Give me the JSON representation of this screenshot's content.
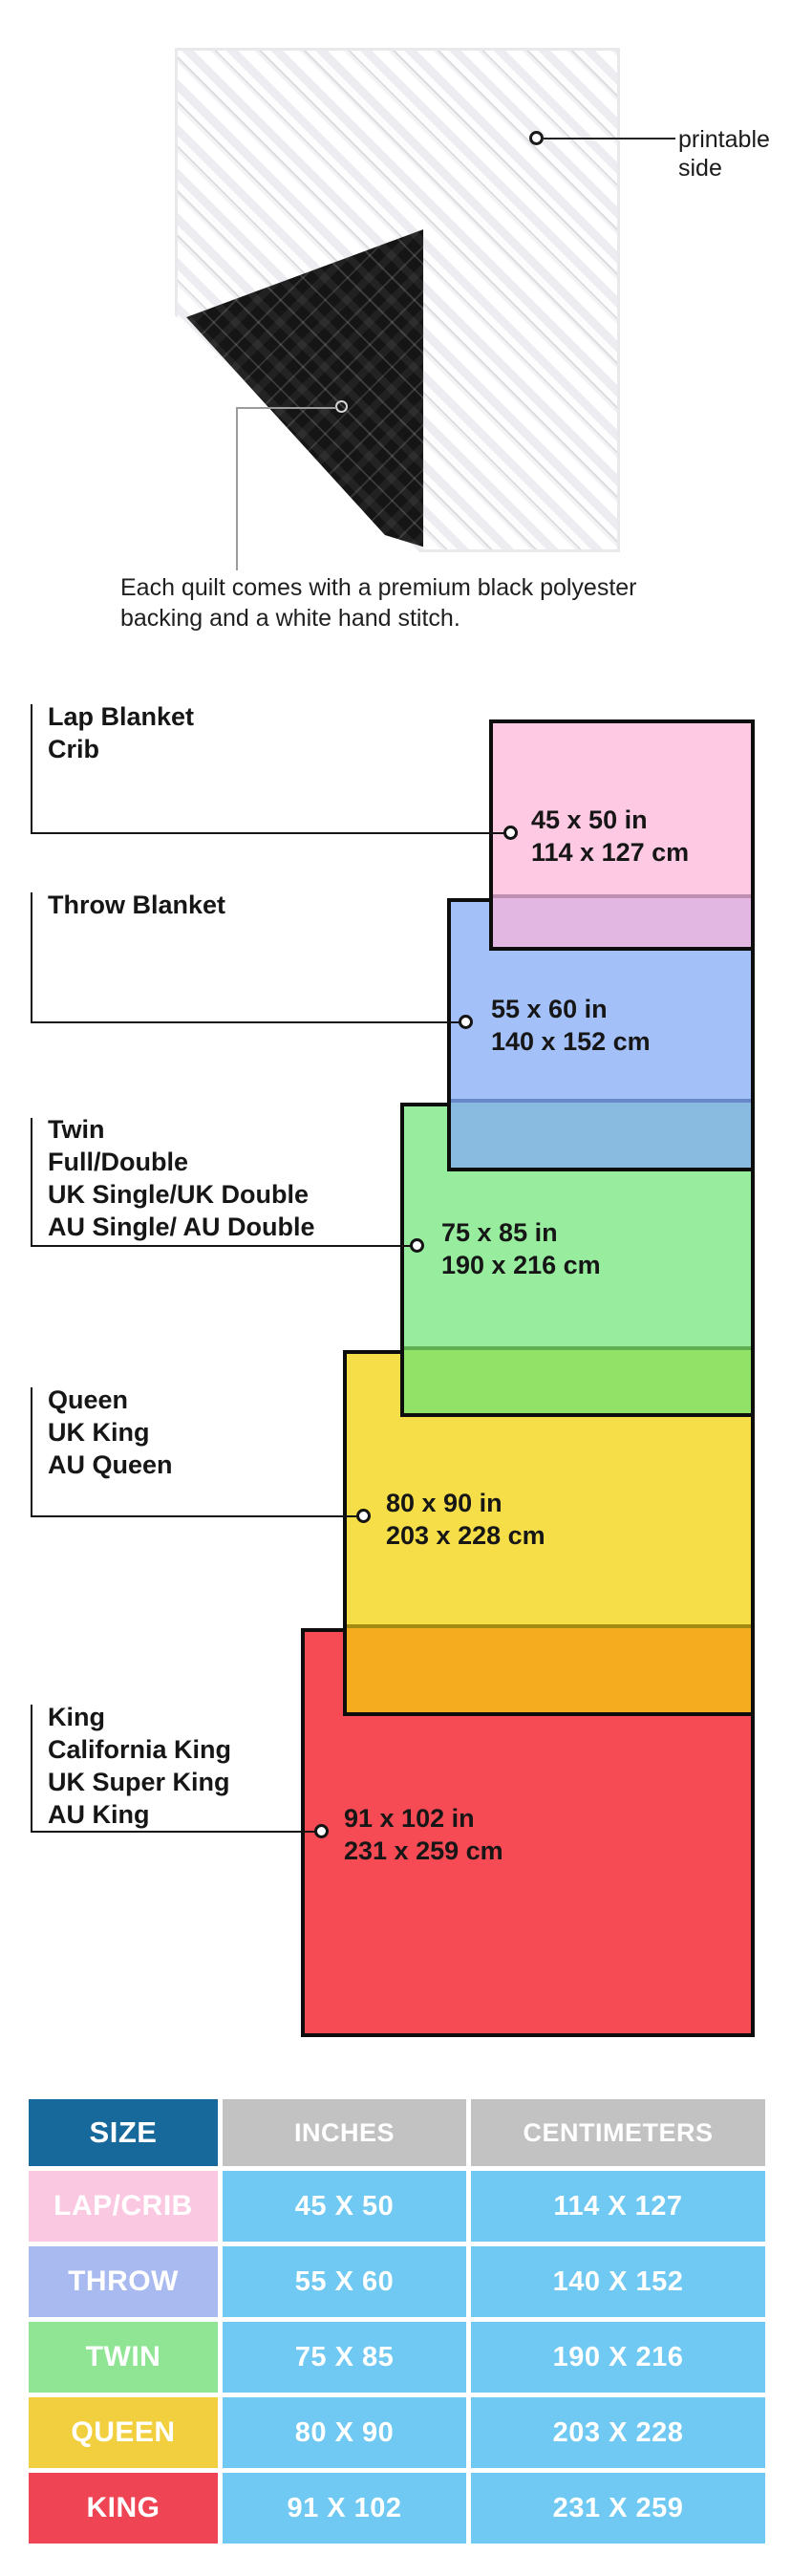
{
  "quilt_figure": {
    "printable_label": "printable side",
    "caption_lines": [
      "Each quilt comes with a premium black polyester",
      "backing and a white hand stitch."
    ],
    "front_color": "#fafafa",
    "backing_color": "#151515"
  },
  "size_diagram": {
    "items": [
      {
        "id": "lap-crib",
        "label_lines": [
          "Lap Blanket",
          "Crib"
        ],
        "inches": "45 x 50 in",
        "centimeters": "114 x 127 cm",
        "fill": "#FEC9E2",
        "overlap_fill": "#E2B7E2"
      },
      {
        "id": "throw",
        "label_lines": [
          "Throw Blanket"
        ],
        "inches": "55 x 60 in",
        "centimeters": "140 x 152 cm",
        "fill": "#A4C0F8",
        "overlap_fill": "#89BBE1"
      },
      {
        "id": "twin",
        "label_lines": [
          "Twin",
          "Full/Double",
          "UK Single/UK Double",
          "AU Single/ AU Double"
        ],
        "inches": "75 x 85 in",
        "centimeters": "190 x 216 cm",
        "fill": "#97EC9E",
        "overlap_fill": "#92E268"
      },
      {
        "id": "queen",
        "label_lines": [
          "Queen",
          "UK King",
          "AU Queen"
        ],
        "inches": "80 x 90 in",
        "centimeters": "203 x 228 cm",
        "fill": "#F5DE48",
        "overlap_fill": "#F5AC1E"
      },
      {
        "id": "king",
        "label_lines": [
          "King",
          "California King",
          "UK Super King",
          "AU King"
        ],
        "inches": "91 x 102 in",
        "centimeters": "231 x 259 cm",
        "fill": "#F64B55"
      }
    ]
  },
  "size_table": {
    "headers": [
      "SIZE",
      "INCHES",
      "CENTIMETERS"
    ],
    "header_size_color": "#17699B",
    "header_gray_color": "#C3C2C2",
    "value_cell_color": "#6FC9F2",
    "rows": [
      {
        "label": "LAP/CRIB",
        "inches": "45 X 50",
        "centimeters": "114 X 127",
        "label_color": "#FBC8E1"
      },
      {
        "label": "THROW",
        "inches": "55 X 60",
        "centimeters": "140 X 152",
        "label_color": "#A9BAF1"
      },
      {
        "label": "TWIN",
        "inches": "75 X 85",
        "centimeters": "190 X 216",
        "label_color": "#90E595"
      },
      {
        "label": "QUEEN",
        "inches": "80 X 90",
        "centimeters": "203 X 228",
        "label_color": "#F2CF3E"
      },
      {
        "label": "KING",
        "inches": "91 X 102",
        "centimeters": "231 X 259",
        "label_color": "#EF4453"
      }
    ]
  }
}
